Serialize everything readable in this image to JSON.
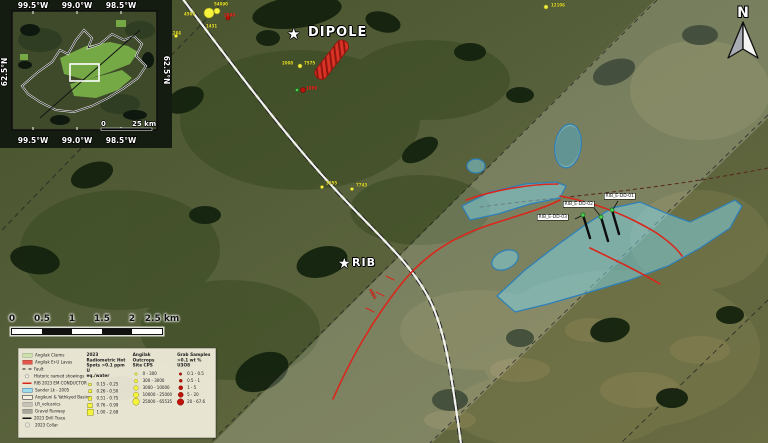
{
  "header": {
    "north_label": "N"
  },
  "inset": {
    "lon_labels": [
      "99.5°W",
      "99.0°W",
      "98.5°W"
    ],
    "lat_label_left": "62.5°N",
    "lat_label_right": "62.5°N",
    "scale_zero": "0",
    "scale_label": "25 km"
  },
  "scalebar": {
    "ticks": [
      "0",
      "0.5",
      "1",
      "1.5",
      "2",
      "2.5 km"
    ]
  },
  "targets": [
    {
      "name": "DIPOLE",
      "x": 308,
      "y": 25,
      "size": 13,
      "star_x": 294,
      "star_y": 35,
      "star_size": 15
    },
    {
      "name": "RIB",
      "x": 352,
      "y": 256,
      "size": 11,
      "star_x": 345,
      "star_y": 265,
      "star_size": 14
    }
  ],
  "drill_labels": [
    {
      "text": "RIB_E-DD-01",
      "x": 604,
      "y": 193
    },
    {
      "text": "RIB_E-DD-02",
      "x": 563,
      "y": 201
    },
    {
      "text": "RIB_E-DD-03",
      "x": 537,
      "y": 214
    }
  ],
  "sample_labels": [
    {
      "text": "54090",
      "x": 214,
      "y": 2,
      "color": "#efe92c",
      "rotate": 0
    },
    {
      "text": "4505",
      "x": 184,
      "y": 12,
      "color": "#efe92c",
      "rotate": 0
    },
    {
      "text": "2849",
      "x": 224,
      "y": 13,
      "color": "#ff2d1e",
      "rotate": 0
    },
    {
      "text": "1431",
      "x": 206,
      "y": 24,
      "color": "#efe92c",
      "rotate": 0
    },
    {
      "text": "1266",
      "x": 170,
      "y": 31,
      "color": "#efe92c",
      "rotate": 0
    },
    {
      "text": "12106",
      "x": 551,
      "y": 3,
      "color": "#efe92c",
      "rotate": 0
    },
    {
      "text": "2008",
      "x": 282,
      "y": 61,
      "color": "#efe92c",
      "rotate": 0
    },
    {
      "text": "7575",
      "x": 304,
      "y": 61,
      "color": "#efe92c",
      "rotate": 0
    },
    {
      "text": "1889",
      "x": 306,
      "y": 86,
      "color": "#ff2d1e",
      "rotate": 0
    },
    {
      "text": "3055",
      "x": 326,
      "y": 181,
      "color": "#efe92c",
      "rotate": 0
    },
    {
      "text": "7743",
      "x": 356,
      "y": 183,
      "color": "#efe92c",
      "rotate": 0
    },
    {
      "text": "4884",
      "x": 372,
      "y": 288,
      "color": "#ff2d1e",
      "rotate": 62
    }
  ],
  "markers": {
    "yellow_dots": [
      {
        "x": 209,
        "y": 13,
        "r": 5
      },
      {
        "x": 217,
        "y": 11,
        "r": 3
      },
      {
        "x": 300,
        "y": 66,
        "r": 2
      },
      {
        "x": 322,
        "y": 187,
        "r": 1.6
      },
      {
        "x": 352,
        "y": 189,
        "r": 1.6
      },
      {
        "x": 546,
        "y": 7,
        "r": 2
      },
      {
        "x": 176,
        "y": 36,
        "r": 1.6
      }
    ],
    "red_dots": [
      {
        "x": 228,
        "y": 18,
        "r": 2
      },
      {
        "x": 303,
        "y": 90,
        "r": 2.5
      }
    ],
    "green_dots": [
      {
        "x": 297,
        "y": 90,
        "r": 1.6
      }
    ]
  },
  "legend": {
    "symbols": [
      {
        "label": "Angilak Claims",
        "type": "patch",
        "color": "#cde1ae"
      },
      {
        "label": "Angilak Er-U Lavas",
        "type": "patch",
        "color": "#e2574a"
      },
      {
        "label": "Fault",
        "type": "dash",
        "color": "#1a1a1a"
      },
      {
        "label": "Historic named showings",
        "type": "star",
        "color": "#ffffff"
      },
      {
        "label": "RIB 2023 EM CONDUCTOR",
        "type": "line",
        "color": "#d8251b"
      },
      {
        "label": "Sander Lk - 2005",
        "type": "patchborder",
        "color": "#9fdce9",
        "border": "#2d6fb0"
      },
      {
        "label": "Angikuni & Yathkyed Basins",
        "type": "patchborder",
        "color": "#f4f1e2",
        "border": "#111111"
      },
      {
        "label": "LR_volcanics",
        "type": "patch",
        "color": "#c7c3b6"
      },
      {
        "label": "Gravel Runway",
        "type": "patch",
        "color": "#a9a69a"
      },
      {
        "label": "2023 Drill Trace",
        "type": "line",
        "color": "#111111"
      },
      {
        "label": "2023 Collar",
        "type": "collar",
        "color": "#8b8f93"
      }
    ],
    "radiometric": {
      "title_lines": [
        "2023 Radiometric Hot",
        "Spots >0.1 ppm U",
        "eq./water"
      ],
      "classes": [
        "0.15 - 0.25",
        "0.26 - 0.50",
        "0.51 - 0.75",
        "0.76 - 0.99",
        "1.00 - 2.68"
      ]
    },
    "outcrops": {
      "title_lines": [
        "Angilak Outcrops",
        "Site CPS",
        ""
      ],
      "classes": [
        "0 - 300",
        "300 - 3000",
        "3000 - 10000",
        "10000 - 25000",
        "25000 - 65535"
      ]
    },
    "grab": {
      "title_lines": [
        "Grab Samples",
        ">0.1 wt % U3O8",
        ""
      ],
      "classes": [
        "0.1 - 0.5",
        "0.5 - 1",
        "1 - 5",
        "5 - 20",
        "20 - 67.6"
      ]
    }
  },
  "colors": {
    "conductor_red": "#d8251b",
    "anomaly_cyan": "#7fd8eb",
    "hotspot_yellow": "#f6f33c",
    "grab_red": "#c01208"
  }
}
